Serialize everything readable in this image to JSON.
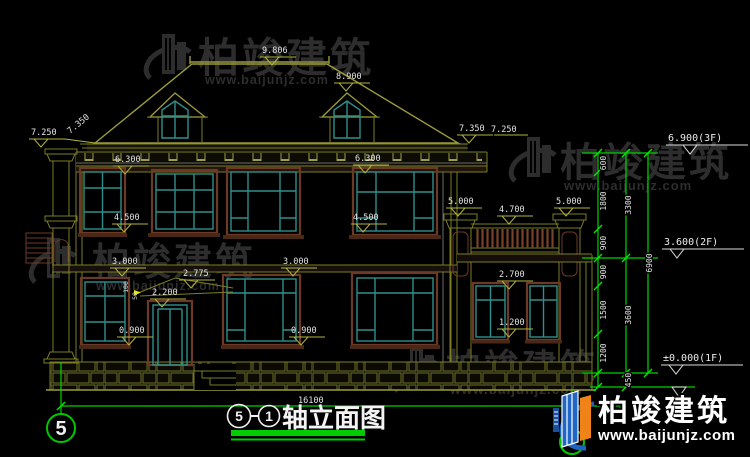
{
  "watermark": {
    "brand": "柏竣建筑",
    "url": "www.baijunjz.com"
  },
  "logo": {
    "brand": "柏竣建筑",
    "url": "www.baijunjz.com"
  },
  "title": {
    "axis_left": "5",
    "axis_right": "1",
    "name": "轴立面图"
  },
  "axis_bubble": {
    "left": "5"
  },
  "dims": {
    "ridge": "9.806",
    "dormer_peak": "8.900",
    "eave_left": "7.250",
    "slope_left": "7.350",
    "slope_right": "7.350",
    "eave_right": "7.250",
    "cornice_left": "6.300",
    "cornice_right": "6.300",
    "sill2_left": "4.500",
    "sill2_right": "4.500",
    "floor2_left": "3.000",
    "floor2_right": "3.000",
    "sill1_left": "0.900",
    "sill1_right": "0.900",
    "canopy_peak": "2.775",
    "door_head": "2.200",
    "canopy_a": "100",
    "canopy_b": "50",
    "pier_left": "5.000",
    "pier_right": "5.000",
    "railing_top": "4.700",
    "annex_head": "2.700",
    "annex_sill": "1.200",
    "total_width": "16100"
  },
  "chain": {
    "seg_600": "600",
    "seg_1800": "1800",
    "seg_900a": "900",
    "seg_900b": "900",
    "seg_1500": "1500",
    "seg_1200": "1200",
    "seg_450": "450",
    "sub_3300": "3300",
    "sub_3600": "3600",
    "total_6900": "6900",
    "level_3f": "6.900(3F)",
    "level_2f": "3.600(2F)",
    "level_1f": "±0.000(1F)"
  }
}
